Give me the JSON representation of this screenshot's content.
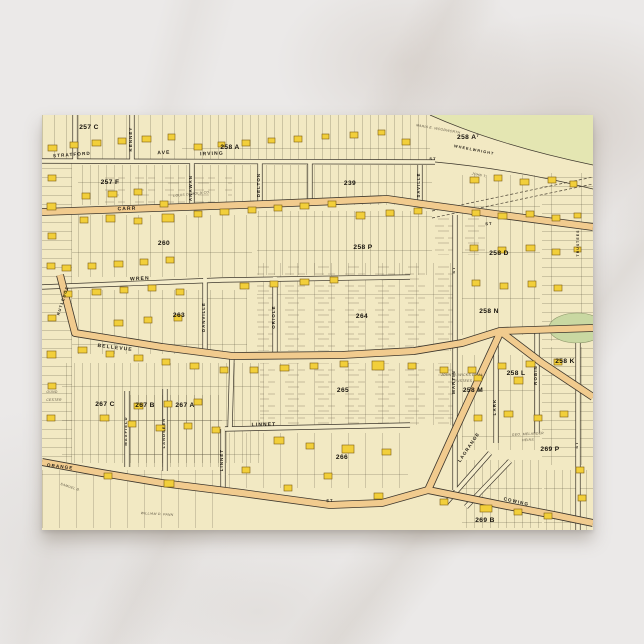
{
  "scene": {
    "background_color": "#ebe9e8",
    "vein_color": "#c8c0b8"
  },
  "postcard": {
    "x": 42,
    "y": 115,
    "width": 551,
    "height": 415,
    "paper_color": "#f2e9c3"
  },
  "map": {
    "palette": {
      "paper": "#f2e9c3",
      "street_fill": "#f4ecca",
      "road_fill": "#f1cb8e",
      "line": "#3c362c",
      "green": "#e4e6b2",
      "pond": "#c9d8a2",
      "building_fill": "#f2cf3a",
      "building_stroke": "#7d5e12",
      "lot_line": "#59513f"
    },
    "green_region": "M388,0 L551,0 L551,50 Q455,30 388,0 Z",
    "curves": [
      "M388,0 Q455,30 551,50",
      "M393,47 Q470,54 551,74"
    ],
    "railroad": [
      "M390,96 L551,62",
      "M390,103 L551,69"
    ],
    "pond": {
      "cx": 535,
      "cy": 213,
      "rx": 28,
      "ry": 15
    },
    "zones": [
      [
        0,
        0,
        140,
        45,
        "v12"
      ],
      [
        140,
        0,
        248,
        45,
        "v8"
      ],
      [
        36,
        50,
        354,
        40,
        "v8"
      ],
      [
        0,
        48,
        30,
        300,
        "h9"
      ],
      [
        30,
        100,
        180,
        62,
        "v12"
      ],
      [
        215,
        96,
        175,
        64,
        "v8"
      ],
      [
        420,
        60,
        78,
        160,
        "v12"
      ],
      [
        500,
        58,
        51,
        168,
        "h9"
      ],
      [
        30,
        175,
        175,
        64,
        "v12"
      ],
      [
        215,
        148,
        196,
        88,
        "v16"
      ],
      [
        215,
        148,
        196,
        88,
        "txt"
      ],
      [
        20,
        248,
        198,
        100,
        "v8"
      ],
      [
        218,
        248,
        194,
        62,
        "v16"
      ],
      [
        218,
        248,
        194,
        62,
        "txt"
      ],
      [
        88,
        280,
        92,
        72,
        "v8"
      ],
      [
        186,
        318,
        180,
        55,
        "v16"
      ],
      [
        420,
        240,
        78,
        95,
        "v12"
      ],
      [
        500,
        232,
        51,
        118,
        "h9"
      ],
      [
        0,
        355,
        180,
        58,
        "v16"
      ],
      [
        420,
        345,
        80,
        68,
        "v8"
      ],
      [
        502,
        355,
        49,
        60,
        "v8"
      ],
      [
        390,
        100,
        55,
        40,
        "txt"
      ],
      [
        60,
        58,
        130,
        36,
        "txt"
      ]
    ],
    "streets": [
      {
        "id": "stratford-irving",
        "k": "s",
        "d": "M0,46 L393,47"
      },
      {
        "id": "kenney",
        "k": "s",
        "d": "M90,0 L90,48"
      },
      {
        "id": "topv1",
        "k": "s",
        "d": "M33,0 L33,46"
      },
      {
        "id": "anawan",
        "k": "s",
        "d": "M150,48 L150,94"
      },
      {
        "id": "delton",
        "k": "s",
        "d": "M218,48 L218,90"
      },
      {
        "id": "topv2",
        "k": "s",
        "d": "M268,48 L268,86"
      },
      {
        "id": "saville",
        "k": "s",
        "d": "M378,50 L378,87"
      },
      {
        "id": "wren",
        "k": "s",
        "d": "M0,172 L180,165 L368,162"
      },
      {
        "id": "danville",
        "k": "s",
        "d": "M163,163 L163,240"
      },
      {
        "id": "oriole",
        "k": "s",
        "d": "M233,162 L233,240"
      },
      {
        "id": "conn1",
        "k": "s",
        "d": "M190,241 L188,313"
      },
      {
        "id": "linnet-h",
        "k": "s",
        "d": "M183,314 L368,310"
      },
      {
        "id": "linnet-v",
        "k": "s",
        "d": "M181,314 L181,375"
      },
      {
        "id": "maxfield",
        "k": "s",
        "d": "M85,276 L85,352"
      },
      {
        "id": "landseer",
        "k": "s",
        "d": "M123,274 L123,356"
      },
      {
        "id": "martin",
        "k": "s",
        "d": "M413,100 L413,375"
      },
      {
        "id": "lark",
        "k": "s",
        "d": "M454,225 L454,328"
      },
      {
        "id": "robin",
        "k": "s",
        "d": "M495,216 L495,318"
      },
      {
        "id": "right-v",
        "k": "s",
        "d": "M536,228 L536,415"
      },
      {
        "id": "fan1",
        "k": "s",
        "d": "M404,388 L448,338"
      },
      {
        "id": "fan2",
        "k": "s",
        "d": "M424,392 L468,346"
      },
      {
        "id": "carr",
        "k": "r",
        "d": "M0,97 L200,90 L345,84 L380,89 L460,100 L551,112"
      },
      {
        "id": "bellevue",
        "k": "r",
        "d": "M18,160 L33,218 L120,232 L190,241 L300,240 L372,236 L420,228 L458,216 L551,213"
      },
      {
        "id": "branch-se",
        "k": "r",
        "d": "M458,216 L500,248 L551,282"
      },
      {
        "id": "lagrange",
        "k": "r",
        "d": "M458,218 L420,300 L386,375"
      },
      {
        "id": "orange-bottom",
        "k": "r",
        "d": "M0,347 L60,358 L120,368 L200,378 L288,390 L340,388 L386,375"
      },
      {
        "id": "cowing",
        "k": "r",
        "d": "M386,375 L460,390 L512,400 L551,408"
      }
    ],
    "street_labels": [
      {
        "t": "STRATFORD",
        "x": 30,
        "y": 41,
        "r": -4,
        "s": 4.6
      },
      {
        "t": "AVE",
        "x": 122,
        "y": 39,
        "r": -2
      },
      {
        "t": "IRVING",
        "x": 170,
        "y": 40,
        "r": -2
      },
      {
        "t": "ST",
        "x": 391,
        "y": 45,
        "r": 0,
        "s": 4
      },
      {
        "t": "KENNEY",
        "x": 90,
        "y": 24,
        "r": -90,
        "s": 4.4
      },
      {
        "t": "ANAWAN",
        "x": 150,
        "y": 73,
        "r": -90,
        "s": 4.4
      },
      {
        "t": "DELTON",
        "x": 218,
        "y": 70,
        "r": -90,
        "s": 4.4
      },
      {
        "t": "SAVILLE",
        "x": 378,
        "y": 70,
        "r": -90,
        "s": 4.2
      },
      {
        "t": "WHEELWRIGHT",
        "x": 432,
        "y": 36,
        "r": 11,
        "s": 3.8
      },
      {
        "t": "CARR",
        "x": 85,
        "y": 95,
        "r": -2
      },
      {
        "t": "ST",
        "x": 447,
        "y": 110,
        "r": -3,
        "s": 4
      },
      {
        "t": "WREN",
        "x": 98,
        "y": 165,
        "r": -3
      },
      {
        "t": "RUTLEDGE",
        "x": 22,
        "y": 186,
        "r": -72,
        "s": 4
      },
      {
        "t": "DANVILLE",
        "x": 163,
        "y": 202,
        "r": -90,
        "s": 4.2
      },
      {
        "t": "ORIOLE",
        "x": 233,
        "y": 202,
        "r": -90,
        "s": 4.4
      },
      {
        "t": "BELLEVUE",
        "x": 73,
        "y": 234,
        "r": 7,
        "s": 5
      },
      {
        "t": "ST",
        "x": 413,
        "y": 155,
        "r": -90,
        "s": 4
      },
      {
        "t": "MARTIN",
        "x": 413,
        "y": 267,
        "r": -90,
        "s": 4.4
      },
      {
        "t": "LARK",
        "x": 454,
        "y": 292,
        "r": -90,
        "s": 4.4
      },
      {
        "t": "ROBIN",
        "x": 495,
        "y": 260,
        "r": -90,
        "s": 4.4
      },
      {
        "t": "LINNET",
        "x": 222,
        "y": 311,
        "r": -1,
        "s": 5
      },
      {
        "t": "LINNET",
        "x": 181,
        "y": 345,
        "r": -90,
        "s": 4.4
      },
      {
        "t": "MAXFIELD",
        "x": 85,
        "y": 316,
        "r": -90,
        "s": 4
      },
      {
        "t": "LANDSEER",
        "x": 123,
        "y": 318,
        "r": -90,
        "s": 4
      },
      {
        "t": "ORANGE",
        "x": 18,
        "y": 353,
        "r": 7,
        "s": 4.6
      },
      {
        "t": "ST",
        "x": 288,
        "y": 387,
        "r": -2,
        "s": 4
      },
      {
        "t": "LAGRANGE",
        "x": 428,
        "y": 333,
        "r": -56,
        "s": 4.6
      },
      {
        "t": "COWING",
        "x": 474,
        "y": 388,
        "r": 13,
        "s": 4.6
      },
      {
        "t": "ST",
        "x": 536,
        "y": 330,
        "r": -90,
        "s": 4
      },
      {
        "t": "TRUSTEES",
        "x": 537,
        "y": 128,
        "r": -90,
        "s": 3.4
      }
    ],
    "plates": [
      {
        "t": "257 C",
        "x": 47,
        "y": 14
      },
      {
        "t": "257 F",
        "x": 68,
        "y": 69
      },
      {
        "t": "258 A",
        "x": 188,
        "y": 34
      },
      {
        "t": "258 A",
        "x": 426,
        "y": 24,
        "sup": "7"
      },
      {
        "t": "239",
        "x": 308,
        "y": 70
      },
      {
        "t": "258 P",
        "x": 321,
        "y": 134
      },
      {
        "t": "258 D",
        "x": 457,
        "y": 140
      },
      {
        "t": "260",
        "x": 122,
        "y": 130
      },
      {
        "t": "263",
        "x": 137,
        "y": 202
      },
      {
        "t": "264",
        "x": 320,
        "y": 203
      },
      {
        "t": "258 N",
        "x": 447,
        "y": 198
      },
      {
        "t": "258 K",
        "x": 523,
        "y": 248
      },
      {
        "t": "258 L",
        "x": 474,
        "y": 260
      },
      {
        "t": "258 M",
        "x": 431,
        "y": 277
      },
      {
        "t": "265",
        "x": 301,
        "y": 277
      },
      {
        "t": "266",
        "x": 300,
        "y": 344
      },
      {
        "t": "267 A",
        "x": 143,
        "y": 292
      },
      {
        "t": "267 B",
        "x": 103,
        "y": 292
      },
      {
        "t": "267 C",
        "x": 63,
        "y": 291
      },
      {
        "t": "269 P",
        "x": 508,
        "y": 336
      },
      {
        "t": "269 B",
        "x": 443,
        "y": 407
      }
    ],
    "owners": [
      {
        "t": "MARIA E. WOODWORTH",
        "x": 396,
        "y": 15,
        "r": 10
      },
      {
        "t": "JOHN T.",
        "x": 437,
        "y": 61,
        "r": 12
      },
      {
        "t": "LOUIS DEMOLD CO.",
        "x": 150,
        "y": 80,
        "r": -6
      },
      {
        "t": "JOHN M. WICKS ET AL",
        "x": 420,
        "y": 261,
        "r": 0
      },
      {
        "t": "TRUSTEES",
        "x": 420,
        "y": 267,
        "r": 0
      },
      {
        "t": "WILLIAM D. PANN",
        "x": 115,
        "y": 400,
        "r": 3
      },
      {
        "t": "SAMUEL B.",
        "x": 28,
        "y": 373,
        "r": 18
      },
      {
        "t": "GEO. MELANDER",
        "x": 486,
        "y": 320,
        "r": -3
      },
      {
        "t": "HEIRS",
        "x": 486,
        "y": 326,
        "r": -3
      },
      {
        "t": "OUND",
        "x": 10,
        "y": 278,
        "r": 0
      },
      {
        "t": "CESTER",
        "x": 12,
        "y": 286,
        "r": 0
      }
    ],
    "buildings": [
      [
        6,
        30,
        9,
        6
      ],
      [
        28,
        27,
        8,
        6
      ],
      [
        50,
        25,
        9,
        6
      ],
      [
        76,
        23,
        8,
        6
      ],
      [
        100,
        21,
        9,
        6
      ],
      [
        126,
        19,
        7,
        6
      ],
      [
        152,
        29,
        8,
        6
      ],
      [
        176,
        27,
        7,
        5
      ],
      [
        200,
        25,
        8,
        6
      ],
      [
        226,
        23,
        7,
        5
      ],
      [
        252,
        21,
        8,
        6
      ],
      [
        280,
        19,
        7,
        5
      ],
      [
        308,
        17,
        8,
        6
      ],
      [
        336,
        15,
        7,
        5
      ],
      [
        360,
        24,
        8,
        6
      ],
      [
        6,
        60,
        8,
        6
      ],
      [
        5,
        88,
        9,
        7
      ],
      [
        6,
        118,
        8,
        6
      ],
      [
        5,
        148,
        8,
        6
      ],
      [
        6,
        200,
        8,
        6
      ],
      [
        5,
        236,
        9,
        7
      ],
      [
        6,
        268,
        8,
        6
      ],
      [
        5,
        300,
        8,
        6
      ],
      [
        40,
        78,
        8,
        6
      ],
      [
        66,
        76,
        9,
        6
      ],
      [
        92,
        74,
        8,
        6
      ],
      [
        118,
        86,
        8,
        6
      ],
      [
        38,
        102,
        8,
        6
      ],
      [
        64,
        100,
        9,
        7
      ],
      [
        92,
        103,
        8,
        6
      ],
      [
        120,
        99,
        12,
        8
      ],
      [
        152,
        96,
        8,
        6
      ],
      [
        178,
        94,
        9,
        6
      ],
      [
        206,
        92,
        8,
        6
      ],
      [
        232,
        90,
        8,
        6
      ],
      [
        258,
        88,
        9,
        6
      ],
      [
        286,
        86,
        8,
        6
      ],
      [
        314,
        97,
        9,
        7
      ],
      [
        344,
        95,
        8,
        6
      ],
      [
        372,
        93,
        8,
        6
      ],
      [
        428,
        62,
        9,
        6
      ],
      [
        452,
        60,
        8,
        6
      ],
      [
        478,
        64,
        9,
        6
      ],
      [
        506,
        62,
        8,
        6
      ],
      [
        528,
        66,
        7,
        6
      ],
      [
        430,
        95,
        8,
        6
      ],
      [
        456,
        98,
        9,
        6
      ],
      [
        484,
        96,
        8,
        6
      ],
      [
        510,
        100,
        8,
        6
      ],
      [
        532,
        98,
        7,
        5
      ],
      [
        428,
        130,
        8,
        6
      ],
      [
        456,
        132,
        8,
        6
      ],
      [
        484,
        130,
        9,
        6
      ],
      [
        510,
        134,
        8,
        6
      ],
      [
        532,
        132,
        7,
        5
      ],
      [
        430,
        165,
        8,
        6
      ],
      [
        458,
        168,
        8,
        6
      ],
      [
        486,
        166,
        8,
        6
      ],
      [
        512,
        170,
        8,
        6
      ],
      [
        20,
        150,
        9,
        6
      ],
      [
        46,
        148,
        8,
        6
      ],
      [
        72,
        146,
        9,
        6
      ],
      [
        98,
        144,
        8,
        6
      ],
      [
        124,
        142,
        8,
        6
      ],
      [
        22,
        176,
        8,
        6
      ],
      [
        50,
        174,
        9,
        6
      ],
      [
        78,
        172,
        8,
        6
      ],
      [
        106,
        170,
        8,
        6
      ],
      [
        134,
        174,
        8,
        6
      ],
      [
        198,
        168,
        9,
        6
      ],
      [
        228,
        166,
        8,
        6
      ],
      [
        258,
        164,
        9,
        6
      ],
      [
        288,
        162,
        8,
        6
      ],
      [
        72,
        205,
        9,
        6
      ],
      [
        102,
        202,
        8,
        6
      ],
      [
        132,
        200,
        8,
        6
      ],
      [
        36,
        232,
        9,
        6
      ],
      [
        64,
        236,
        8,
        6
      ],
      [
        92,
        240,
        9,
        6
      ],
      [
        120,
        244,
        8,
        6
      ],
      [
        148,
        248,
        9,
        6
      ],
      [
        178,
        252,
        8,
        6
      ],
      [
        208,
        252,
        8,
        6
      ],
      [
        238,
        250,
        9,
        6
      ],
      [
        268,
        248,
        8,
        6
      ],
      [
        298,
        246,
        8,
        6
      ],
      [
        330,
        246,
        12,
        9
      ],
      [
        366,
        248,
        8,
        6
      ],
      [
        398,
        252,
        8,
        6
      ],
      [
        426,
        252,
        8,
        6
      ],
      [
        456,
        248,
        8,
        6
      ],
      [
        484,
        246,
        9,
        6
      ],
      [
        512,
        244,
        8,
        6
      ],
      [
        58,
        300,
        9,
        6
      ],
      [
        86,
        306,
        8,
        6
      ],
      [
        114,
        310,
        9,
        6
      ],
      [
        142,
        308,
        8,
        6
      ],
      [
        170,
        312,
        8,
        6
      ],
      [
        92,
        288,
        9,
        6
      ],
      [
        122,
        286,
        8,
        6
      ],
      [
        152,
        284,
        8,
        6
      ],
      [
        232,
        322,
        10,
        7
      ],
      [
        264,
        328,
        8,
        6
      ],
      [
        300,
        330,
        12,
        8
      ],
      [
        340,
        334,
        9,
        6
      ],
      [
        432,
        300,
        8,
        6
      ],
      [
        462,
        296,
        9,
        6
      ],
      [
        492,
        300,
        8,
        6
      ],
      [
        518,
        296,
        8,
        6
      ],
      [
        432,
        260,
        8,
        6
      ],
      [
        472,
        262,
        9,
        7
      ],
      [
        62,
        358,
        8,
        6
      ],
      [
        122,
        365,
        10,
        7
      ],
      [
        242,
        370,
        8,
        6
      ],
      [
        332,
        378,
        9,
        6
      ],
      [
        398,
        384,
        8,
        6
      ],
      [
        438,
        390,
        12,
        7
      ],
      [
        472,
        394,
        8,
        6
      ],
      [
        502,
        398,
        8,
        6
      ],
      [
        534,
        352,
        8,
        6
      ],
      [
        536,
        380,
        8,
        6
      ],
      [
        200,
        352,
        8,
        6
      ],
      [
        282,
        358,
        8,
        6
      ]
    ]
  }
}
